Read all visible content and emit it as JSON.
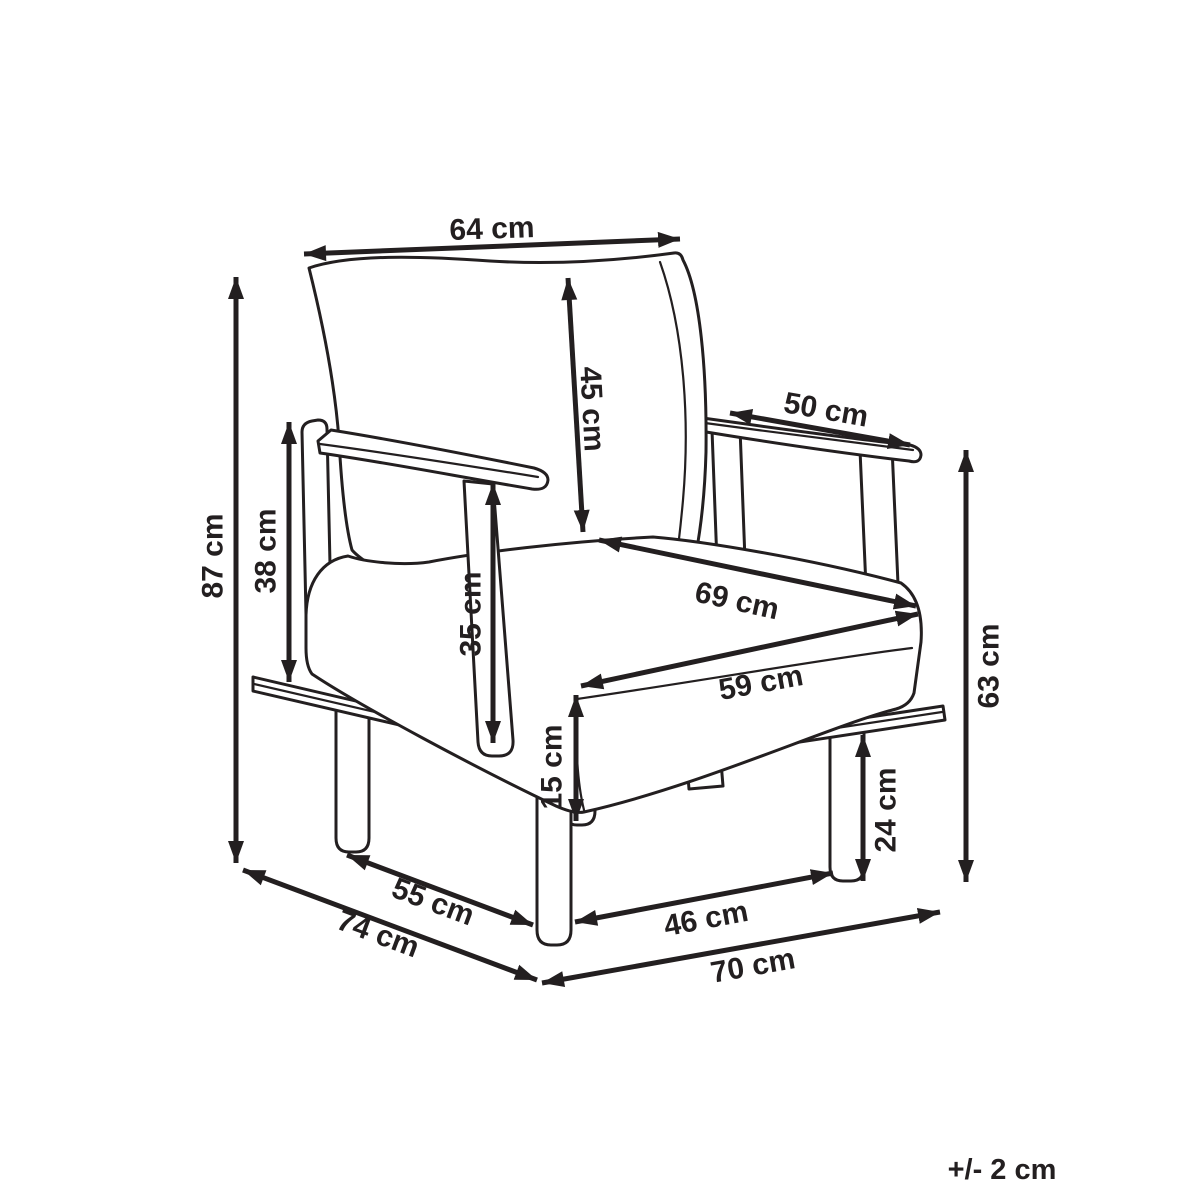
{
  "page": {
    "background": "#ffffff",
    "ink_color": "#231f20"
  },
  "diagram": {
    "subject": "armchair dimension drawing",
    "tolerance_note": "+/- 2 cm",
    "dimensions": [
      {
        "id": "backrest-width",
        "label": "64 cm"
      },
      {
        "id": "backrest-height",
        "label": "45 cm"
      },
      {
        "id": "armrest-length",
        "label": "50 cm"
      },
      {
        "id": "overall-height",
        "label": "87 cm"
      },
      {
        "id": "armrest-rear-height",
        "label": "38 cm"
      },
      {
        "id": "armrest-front-height",
        "label": "35 cm"
      },
      {
        "id": "seat-diagonal-depth",
        "label": "69 cm"
      },
      {
        "id": "seat-front-width",
        "label": "59 cm"
      },
      {
        "id": "cushion-thickness",
        "label": "15 cm"
      },
      {
        "id": "arm-side-height",
        "label": "63 cm"
      },
      {
        "id": "leg-height",
        "label": "24 cm"
      },
      {
        "id": "base-side-depth",
        "label": "55 cm"
      },
      {
        "id": "overall-depth",
        "label": "74 cm"
      },
      {
        "id": "front-leg-span",
        "label": "46 cm"
      },
      {
        "id": "overall-width",
        "label": "70 cm"
      }
    ]
  }
}
